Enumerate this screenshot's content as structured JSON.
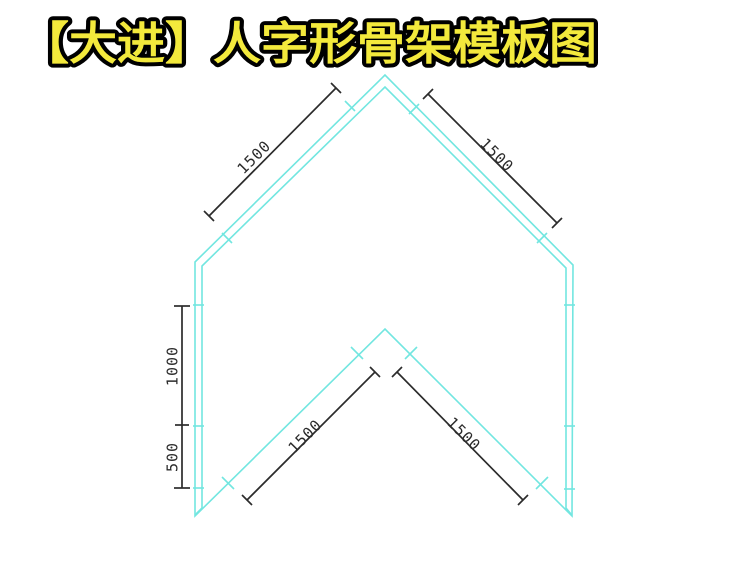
{
  "title": "【大进】人字形骨架模板图",
  "colors": {
    "background": "#ffffff",
    "frame_line": "#72e6e0",
    "dimension_line": "#2b2b2b",
    "title_fill": "#f3e93c",
    "title_outline": "#000000"
  },
  "drawing": {
    "name": "herringbone-skeleton-template",
    "dimensions": {
      "outer_left_slope": "1500",
      "outer_right_slope": "1500",
      "left_side_upper": "1000",
      "left_side_lower": "500",
      "inner_left_slope": "1500",
      "inner_right_slope": "1500"
    }
  }
}
